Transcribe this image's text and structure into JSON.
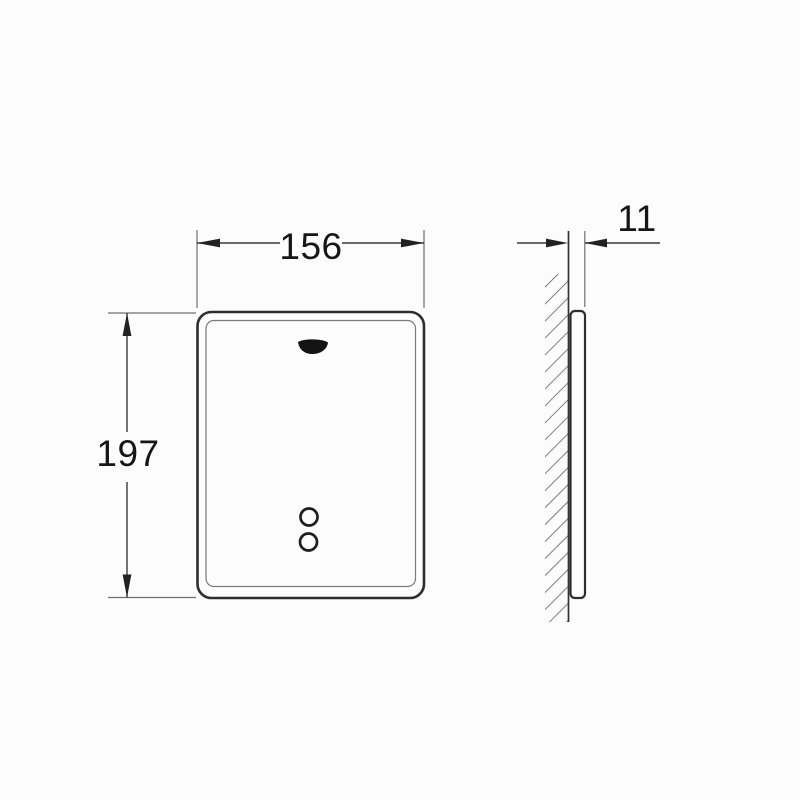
{
  "drawing": {
    "front_view": {
      "width_label": "156",
      "height_label": "197"
    },
    "side_view": {
      "thickness_label": "11"
    },
    "colors": {
      "background": "#fcfcfc",
      "outline": "#2e2e2e",
      "inner_edge": "#7a7a7a",
      "dimension_line": "#3a3a3a",
      "extension_line": "#6f6f6f",
      "hatch": "#4a4a4a",
      "label_text": "#161616"
    }
  }
}
